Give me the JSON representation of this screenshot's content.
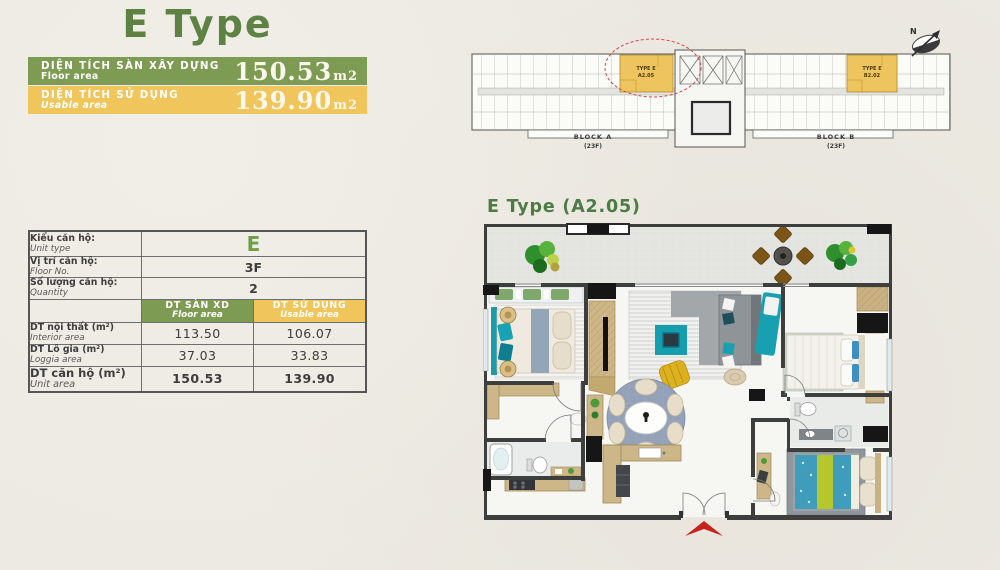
{
  "page": {
    "title": "E Type"
  },
  "area_banners": [
    {
      "label_vi": "DIỆN TÍCH SÀN XÂY DỰNG",
      "label_en": "Floor area",
      "value": "150.53",
      "unit": "m2",
      "color": "#7e9b54"
    },
    {
      "label_vi": "DIỆN TÍCH SỬ DỤNG",
      "label_en": "Usable area",
      "value": "139.90",
      "unit": "m2",
      "color": "#f0c65c"
    }
  ],
  "site_plan": {
    "compass_label": "N",
    "unit_a": {
      "line1": "TYPE E",
      "line2": "A2.05"
    },
    "unit_b": {
      "line1": "TYPE E",
      "line2": "B2.02"
    },
    "block_a": {
      "name": "BLOCK A",
      "floors": "(23F)"
    },
    "block_b": {
      "name": "BLOCK B",
      "floors": "(23F)"
    },
    "highlight_color": "#eec45f",
    "annotation_color": "#cf4343"
  },
  "info_table": {
    "rows": [
      {
        "label_vi": "Kiểu căn hộ:",
        "label_en": "Unit type",
        "value": "E"
      },
      {
        "label_vi": "Vị trí căn hộ:",
        "label_en": "Floor No.",
        "value": "3F"
      },
      {
        "label_vi": "Số lượng căn hộ:",
        "label_en": "Quantity",
        "value": "2"
      }
    ],
    "columns": [
      {
        "label_vi": "DT SÀN XD",
        "label_en": "Floor area",
        "color": "#7e9b54"
      },
      {
        "label_vi": "DT SỬ DỤNG",
        "label_en": "Usable area",
        "color": "#f0c65c"
      }
    ],
    "area_rows": [
      {
        "label_vi": "DT nội thất (m²)",
        "label_en": "Interior area",
        "floor": "113.50",
        "usable": "106.07"
      },
      {
        "label_vi": "DT Lô gia (m²)",
        "label_en": "Loggia area",
        "floor": "37.03",
        "usable": "33.83"
      },
      {
        "label_vi": "DT căn hộ (m²)",
        "label_en": "Unit area",
        "floor": "150.53",
        "usable": "139.90"
      }
    ]
  },
  "floor_plan": {
    "heading": "E Type (A2.05)",
    "palette": {
      "background": "#ece9e2",
      "title_green": "#5d8243",
      "wall": "#3d3e3e",
      "wood": "#cdb687",
      "teal": "#17a0b0",
      "sofa_gray": "#8f9498",
      "dining_rug_blue": "#93a2b8",
      "yellow_chair": "#ddb01e",
      "bed_blue": "#3f9cba",
      "lime_stripe": "#b6c72e",
      "entry_arrow_red": "#c5251c",
      "balcony_floor": "#e4e4e0",
      "interior_floor": "#f6f6f3"
    }
  }
}
